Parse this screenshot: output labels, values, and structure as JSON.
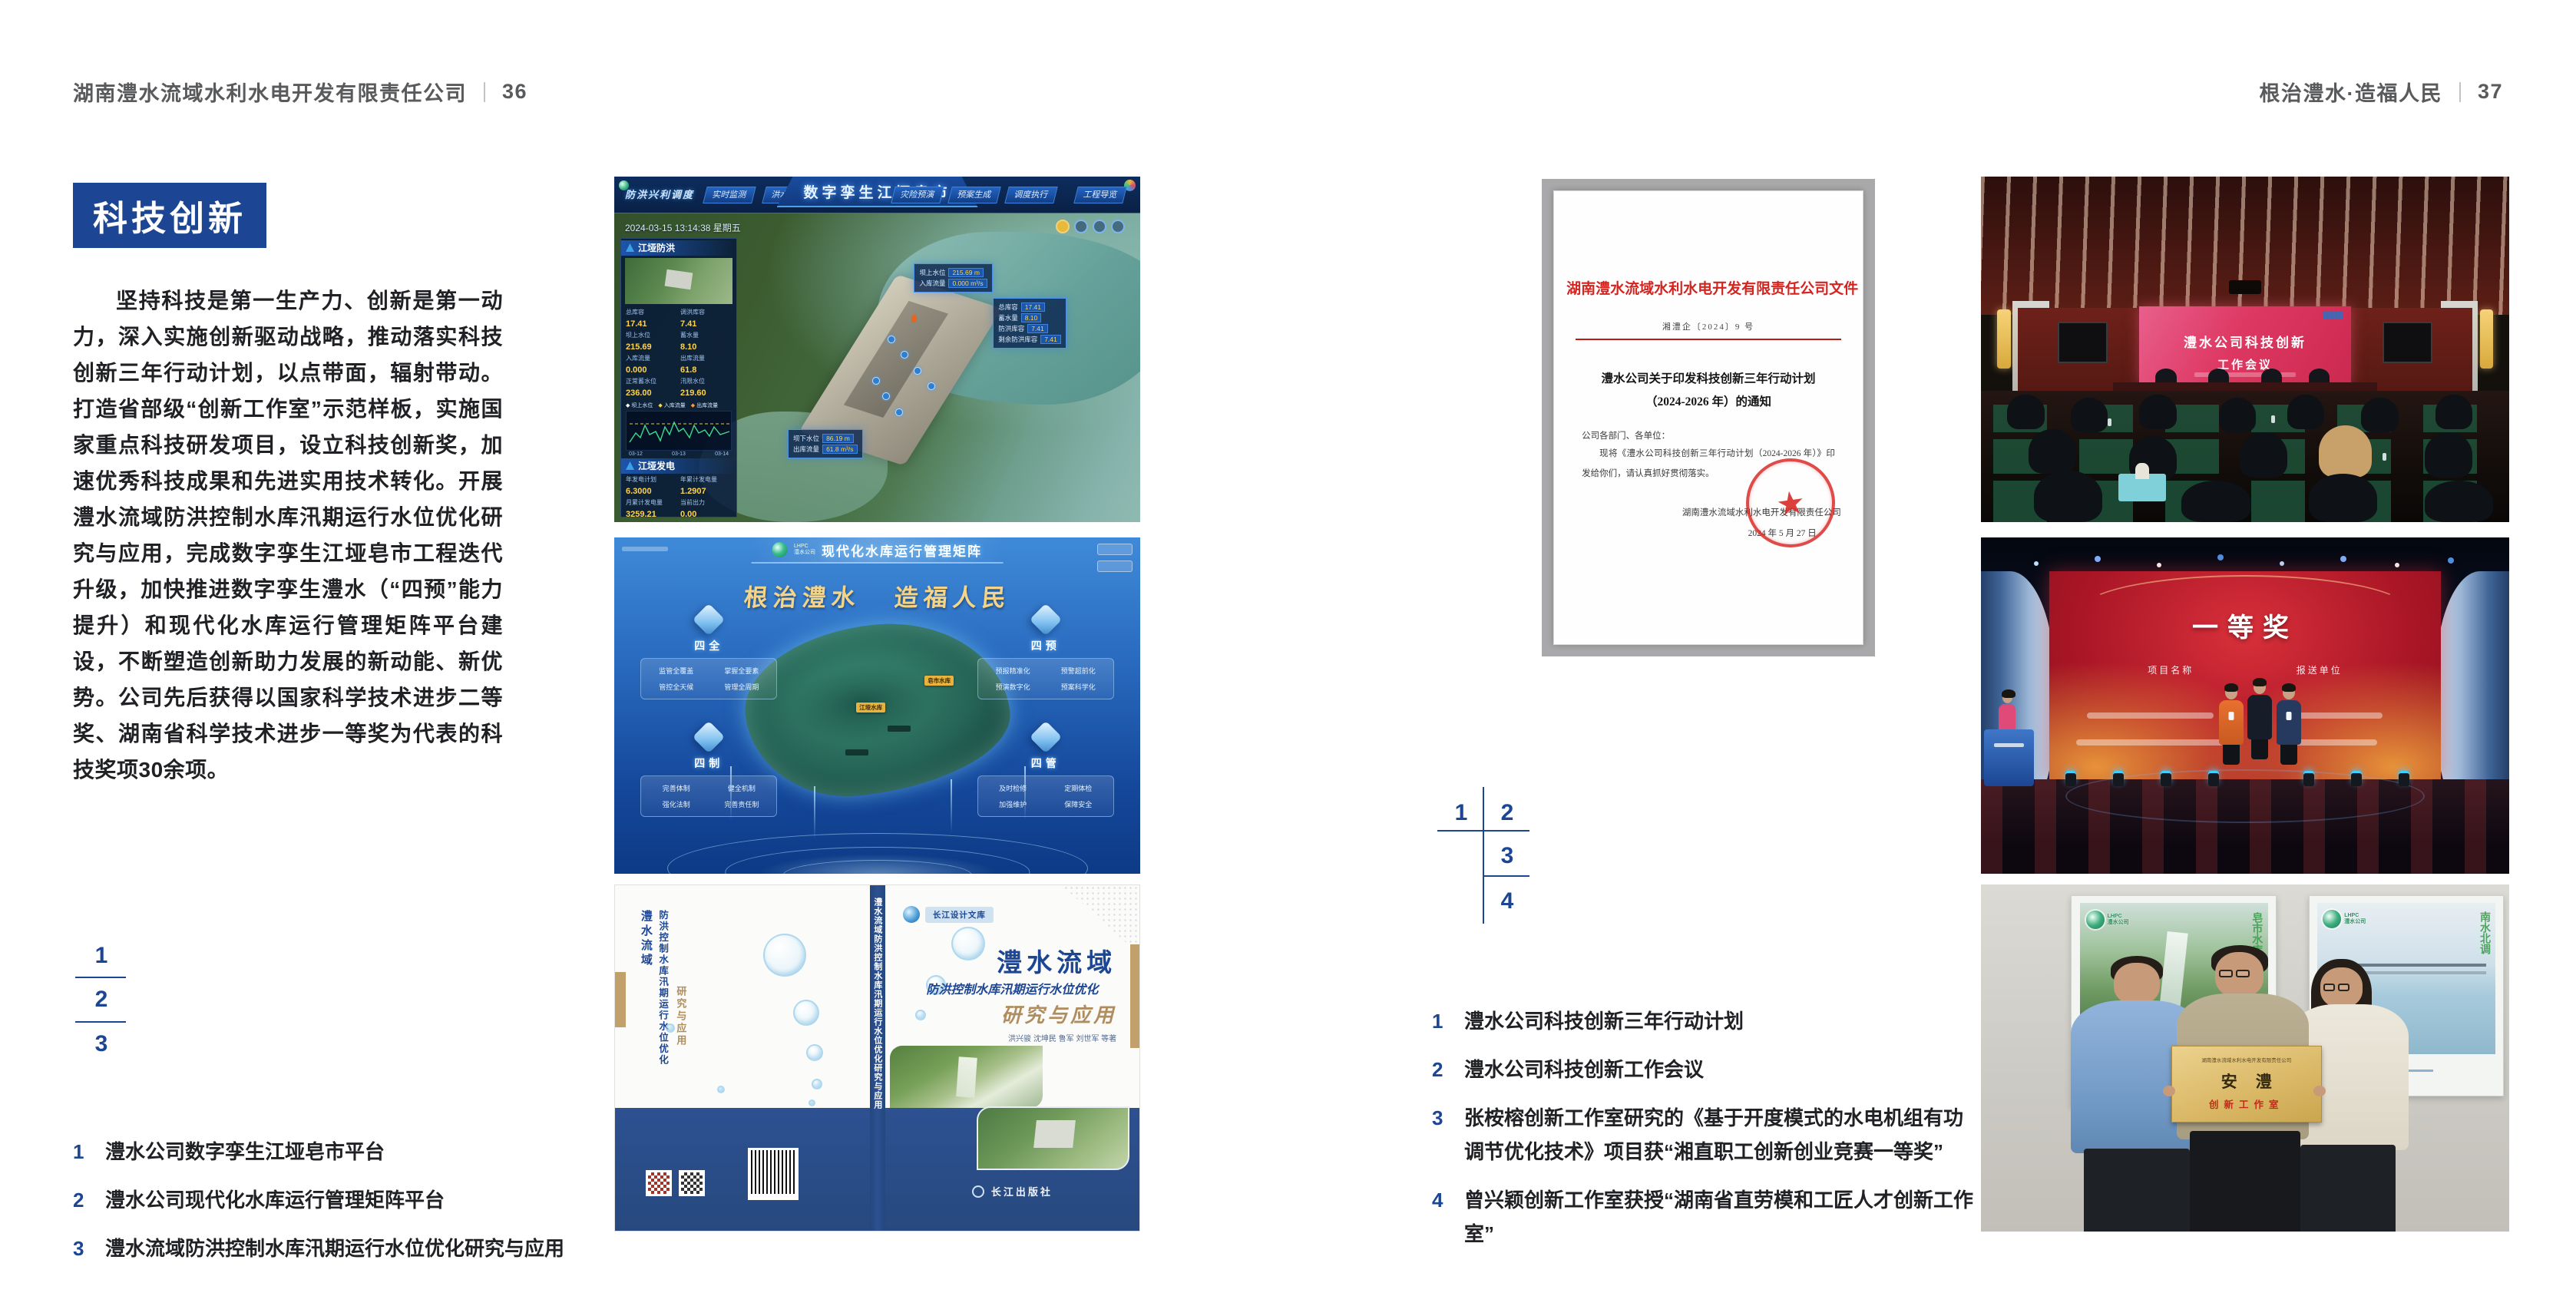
{
  "page": {
    "left_header": {
      "company": "湖南澧水流域水利水电开发有限责任公司",
      "page_no": "36"
    },
    "right_header": {
      "slogan": "根治澧水·造福人民",
      "page_no": "37"
    }
  },
  "section": {
    "title": "科技创新",
    "body": "坚持科技是第一生产力、创新是第一动力，深入实施创新驱动战略，推动落实科技创新三年行动计划，以点带面，辐射带动。打造省部级“创新工作室”示范样板，实施国家重点科技研发项目，设立科技创新奖，加速优秀科技成果和先进实用技术转化。开展澧水流域防洪控制水库汛期运行水位优化研究与应用，完成数字孪生江垭皂市工程迭代升级，加快推进数字孪生澧水（“四预”能力提升）和现代化水库运行管理矩阵平台建设，不断塑造创新助力发展的新动能、新优势。公司先后获得以国家科学技术进步二等奖、湖南省科学技术进步一等奖为代表的科技奖项30余项。"
  },
  "left_figure_index": {
    "n1": "1",
    "n2": "2",
    "n3": "3"
  },
  "right_figure_index": {
    "n1": "1",
    "n2": "2",
    "n3": "3",
    "n4": "4"
  },
  "left_captions": [
    {
      "num": "1",
      "text": "澧水公司数字孪生江垭皂市平台"
    },
    {
      "num": "2",
      "text": "澧水公司现代化水库运行管理矩阵平台"
    },
    {
      "num": "3",
      "text": "澧水流域防洪控制水库汛期运行水位优化研究与应用"
    }
  ],
  "right_captions": [
    {
      "num": "1",
      "text": "澧水公司科技创新三年行动计划"
    },
    {
      "num": "2",
      "text": "澧水公司科技创新工作会议"
    },
    {
      "num": "3",
      "text": "张桉榕创新工作室研究的《基于开度模式的水电机组有功调节优化技术》项目获“湘直职工创新创业竞赛一等奖”"
    },
    {
      "num": "4",
      "text": "曾兴颖创新工作室获授“湖南省直劳模和工匠人才创新工作室”"
    }
  ],
  "dashboard": {
    "title": "数字孪生江垭皂市",
    "corner_label": "防洪兴利调度",
    "datetime": "2024-03-15 13:14:38 星期五",
    "tabs_left": [
      "实时监测",
      "洪水预报",
      "防洪预警"
    ],
    "tabs_right": [
      "灾险预演",
      "预案生成",
      "调度执行",
      "工程导览"
    ],
    "panel_flood": {
      "title": "江垭防洪",
      "metrics": [
        {
          "l": "总库容",
          "v": "17.41"
        },
        {
          "l": "调洪库容",
          "v": "7.41"
        },
        {
          "l": "坝上水位",
          "v": "215.69"
        },
        {
          "l": "蓄水量",
          "v": "8.10"
        },
        {
          "l": "入库流量",
          "v": "0.000"
        },
        {
          "l": "出库流量",
          "v": "61.8"
        },
        {
          "l": "正常蓄水位",
          "v": "236.00"
        },
        {
          "l": "汛限水位",
          "v": "219.60"
        }
      ],
      "legend": [
        "坝上水位",
        "入库流量",
        "出库流量"
      ],
      "x_ticks": [
        "03-12",
        "03-13",
        "03-14"
      ]
    },
    "panel_power": {
      "title": "江垭发电",
      "metrics": [
        {
          "l": "年发电计划",
          "v": "6.3000"
        },
        {
          "l": "年累计发电量",
          "v": "1.2907"
        },
        {
          "l": "月累计发电量",
          "v": "3259.21"
        },
        {
          "l": "当前出力",
          "v": "0.00"
        },
        {
          "l": "发电流量",
          "v": "0.00"
        },
        {
          "l": "弃水流量",
          "v": "0.00"
        }
      ]
    },
    "tip_up": {
      "rows": [
        {
          "l": "坝上水位",
          "v": "215.69 m"
        },
        {
          "l": "入库流量",
          "v": "0.000 m³/s"
        }
      ]
    },
    "tip_right": {
      "rows": [
        {
          "l": "总库容",
          "v": "17.41"
        },
        {
          "l": "蓄水量",
          "v": "8.10"
        },
        {
          "l": "防洪库容",
          "v": "7.41"
        },
        {
          "l": "剩余防洪库容",
          "v": "7.41"
        }
      ]
    },
    "tip_down": {
      "rows": [
        {
          "l": "坝下水位",
          "v": "86.19 m"
        },
        {
          "l": "出库流量",
          "v": "61.8 m³/s"
        }
      ]
    }
  },
  "matrix": {
    "logo_line1": "LHPC",
    "logo_line2": "澧水公司",
    "title": "现代化水库运行管理矩阵",
    "slogan_left": "根治澧水",
    "slogan_right": "造福人民",
    "map_tags": [
      "皂市水库",
      "江垭水库"
    ],
    "quadrants": [
      {
        "name": "四全",
        "items": [
          "监管全覆盖",
          "掌握全要素",
          "管控全天候",
          "管理全周期"
        ]
      },
      {
        "name": "四预",
        "items": [
          "预报精准化",
          "预警超前化",
          "预演数字化",
          "预案科学化"
        ]
      },
      {
        "name": "四制",
        "items": [
          "完善体制",
          "健全机制",
          "强化法制",
          "完善责任制"
        ]
      },
      {
        "name": "四管",
        "items": [
          "及时检修",
          "定期体检",
          "加强维护",
          "保障安全"
        ]
      }
    ]
  },
  "book": {
    "series": "长江设计文库",
    "title_main": "澧水流域",
    "title_sub": "防洪控制水库汛期运行水位优化",
    "title_tail": "研究与应用",
    "authors": "洪兴骏  沈坤民  鲁军  刘世军  等著",
    "publisher": "长江出版社",
    "spine_text": "澧水流域防洪控制水库汛期运行水位优化研究与应用",
    "back_title_1": "澧水流域",
    "back_title_2": "防洪控制水库汛期运行水位优化",
    "back_title_3": "研究与应用"
  },
  "redhead_doc": {
    "header": "湖南澧水流域水利水电开发有限责任公司文件",
    "doc_no": "湘澧企〔2024〕9 号",
    "title_line1": "澧水公司关于印发科技创新三年行动计划",
    "title_line2": "（2024-2026 年）的通知",
    "salutation": "公司各部门、各单位：",
    "body": "现将《澧水公司科技创新三年行动计划（2024-2026 年）》印发给你们，请认真抓好贯彻落实。",
    "signer": "湖南澧水流域水利水电开发有限责任公司",
    "date": "2024 年 5 月 27 日"
  },
  "meeting": {
    "screen_line1": "澧水公司科技创新",
    "screen_line2": "工作会议"
  },
  "award": {
    "prize": "一等奖",
    "col_left": "项目名称",
    "col_right": "报送单位"
  },
  "group_photo": {
    "logo_line1": "LHPC",
    "logo_line2": "澧水公司",
    "poster_left_vertical": "皂市水库",
    "poster_right_vertical": "南水北调",
    "plaque_org": "湖南澧水流域水利水电开发有限责任公司",
    "plaque_title": "安澧",
    "plaque_sub": "创新工作室"
  }
}
